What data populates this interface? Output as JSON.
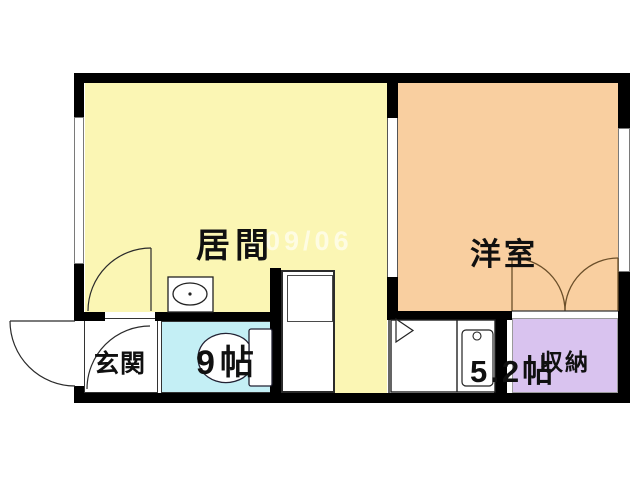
{
  "floorplan": {
    "watermark": "109/06",
    "colors": {
      "living": "#fbf6b4",
      "western": "#f9cfa0",
      "toilet": "#c4eff5",
      "closet": "#d9c3ef",
      "wall": "#000000"
    },
    "rooms": {
      "living": {
        "label": "居間",
        "size": "9帖"
      },
      "western": {
        "label": "洋室",
        "size": "5.2帖"
      },
      "entrance": {
        "label": "玄関"
      },
      "closet": {
        "label": "収納"
      }
    },
    "fixtures": {
      "icons": [
        "toilet-icon",
        "wash-basin-icon",
        "kitchen-sink-counter-icon",
        "refrigerator-space-icon",
        "entrance-swing-door-icon",
        "living-swing-door-icon",
        "hall-swing-door-icon",
        "closet-double-doors-icon",
        "left-window",
        "right-window",
        "room-divider-opening"
      ]
    }
  }
}
